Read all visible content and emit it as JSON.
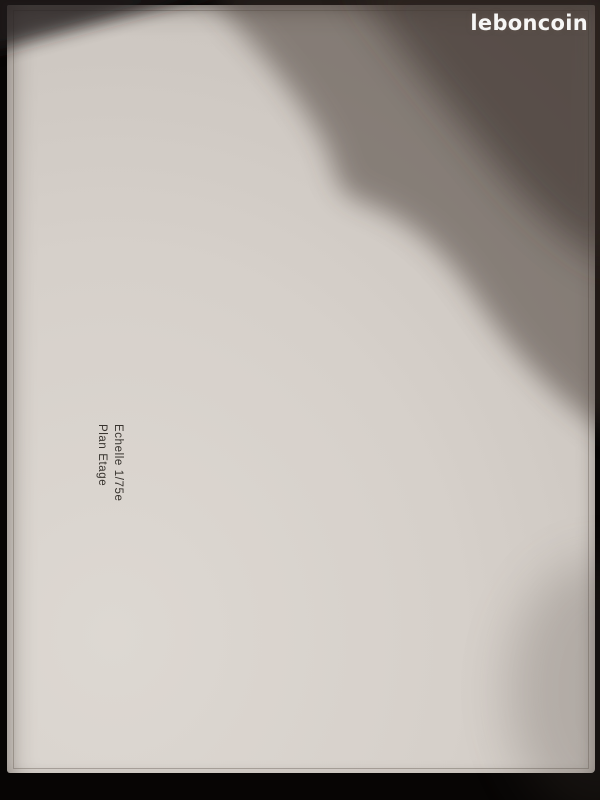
{
  "watermark": "leboncoin",
  "title": {
    "line1": "Plan Etage",
    "line2": "Echelle 1/75e"
  },
  "dims": {
    "top_total": "14,59",
    "top_left": "8,69",
    "top_right": "5,90",
    "bottom_total": "14,59",
    "bottom_left": "5,50",
    "bottom_right": "9,09",
    "block_width": "8,34",
    "block_height_left": "8,34",
    "block_height_right": "8,34",
    "roof_ridge": "8,34",
    "roof_right_top": "3,36",
    "roof_right_bottom": "4,60",
    "left_seg": "2,37",
    "left_mid": "1,81",
    "left_window": "90/1,35",
    "right_seg": "1,98",
    "right_mid": "2,38",
    "right_window": "1,00/1,35",
    "window_h": "H=90"
  },
  "rooms": {
    "bains": {
      "name": "Bains",
      "area": "7,70 m²"
    },
    "wc": {
      "name": "WC",
      "area": "1,50 m²"
    },
    "chambre3": {
      "name": "Chambre 3",
      "area": "14,15 m²"
    },
    "degagement": {
      "name": "Dégagement",
      "area": "6,00 m²"
    },
    "chambre2": {
      "name": "Chambre 2",
      "area": "14,20 m²"
    }
  },
  "inner": {
    "bains_width": "2,58",
    "vanity_side": "69",
    "vanity_width": "1,20",
    "cloison_label": "cloison",
    "cloison_size": "180",
    "carrelage": "Carrelage",
    "bed_width": "3,97",
    "wall_len": "2,90",
    "deg_width": "4,65",
    "deg_seg": "1,62",
    "stair_width": "2,10",
    "stair_depth": "1,60",
    "hall_len": "1,97",
    "risers": "16"
  },
  "marks": {
    "outer_wall": "22",
    "inner_shell": "14",
    "partition": "7"
  },
  "notes": {
    "titan": "TITAN",
    "grille": "Grille Hygro"
  },
  "colors": {
    "paper": "#d6d0ca",
    "ink": "#3f3b36",
    "wall": "#24211e",
    "shadow": "#41352f",
    "logo": "#ffffff"
  }
}
